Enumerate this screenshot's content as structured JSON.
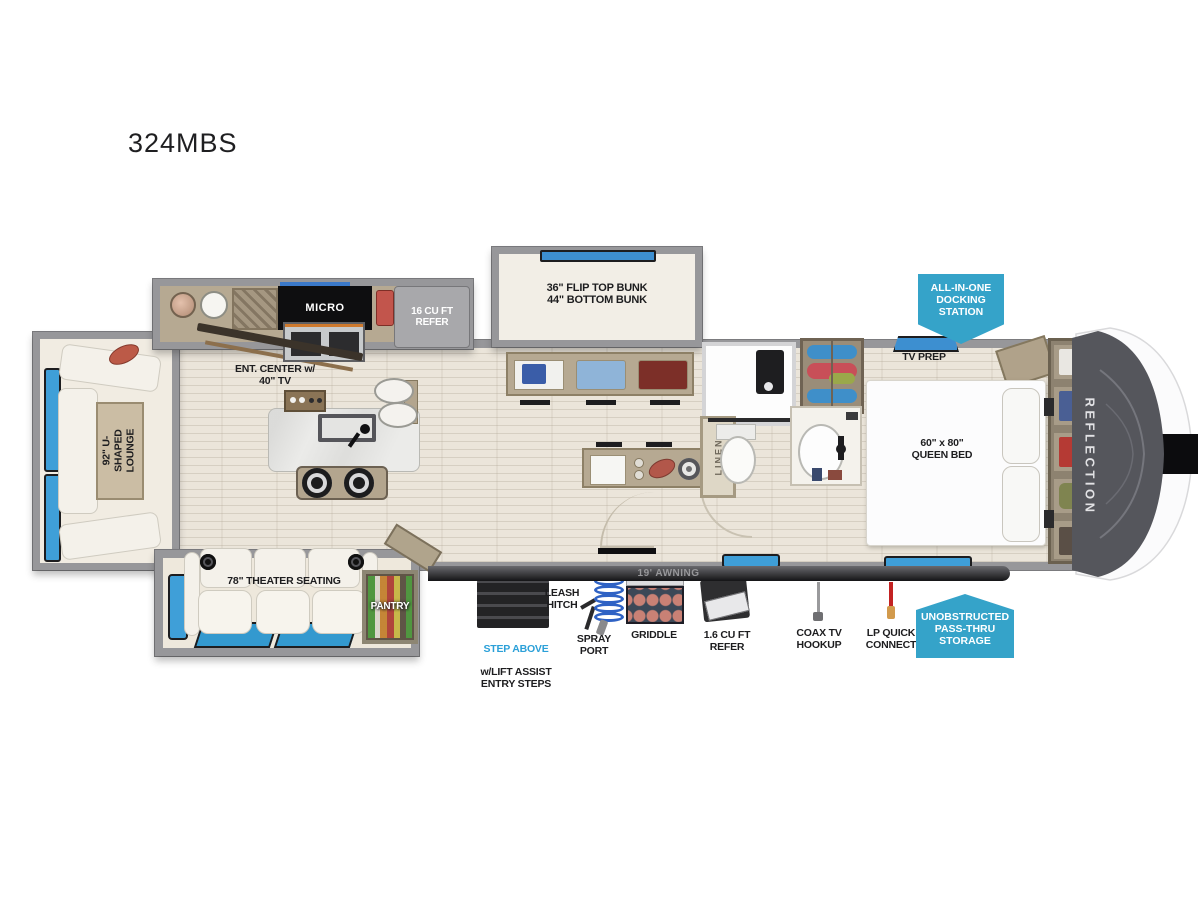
{
  "title": "324MBS",
  "colors": {
    "badge_blue": "#35a3c9",
    "step_blue": "#2ba0d8",
    "window_blue": "#3f9fd8",
    "label_dark": "#1d1d1f"
  },
  "labels": {
    "lounge": "92\" U-SHAPED\nLOUNGE",
    "ent_center": "ENT. CENTER w/\n40\" TV",
    "micro": "MICRO",
    "refer": "16 CU FT\nREFER",
    "bunk": "36\" FLIP TOP BUNK\n44\" BOTTOM BUNK",
    "linen": "LINEN",
    "tv_prep": "TV PREP",
    "queen_bed": "60\" x 80\"\nQUEEN BED",
    "brand": "REFLECTION",
    "theater": "78\" THEATER SEATING",
    "pantry": "PANTRY"
  },
  "badges": {
    "docking": "ALL-IN-ONE\nDOCKING\nSTATION",
    "storage": "UNOBSTRUCTED\nPASS-THRU\nSTORAGE"
  },
  "exterior": {
    "awning": "19' AWNING",
    "step_above": "STEP ABOVE",
    "step_sub": "w/LIFT ASSIST\nENTRY STEPS",
    "leash_hitch": "LEASH\nHITCH",
    "spray_port": "SPRAY\nPORT",
    "griddle": "GRIDDLE",
    "mini_refer": "1.6 CU FT\nREFER",
    "coax": "COAX TV\nHOOKUP",
    "lp": "LP QUICK\nCONNECT"
  }
}
